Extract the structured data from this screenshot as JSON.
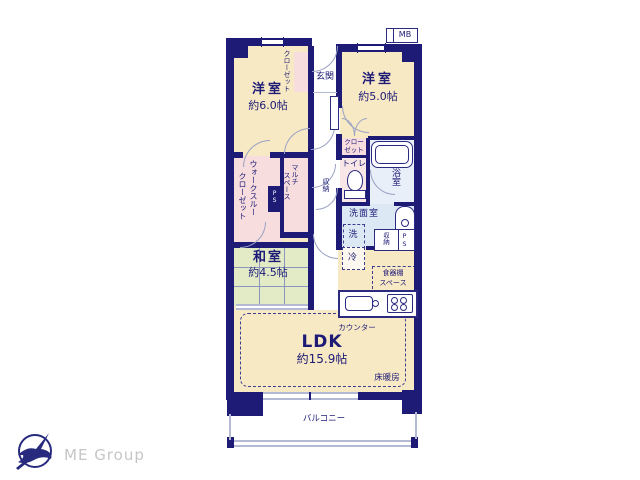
{
  "colors": {
    "wall": "#1d1b76",
    "room_cream": "#f8e9c5",
    "room_pink": "#f7dddd",
    "room_blue": "#dce8f4",
    "room_bath": "#e9eff8",
    "room_green": "#e2ebc6",
    "door_line": "#9aa2c4",
    "text_navy": "#1d1b76",
    "logo_gray": "#c6c6c6"
  },
  "plan": {
    "mb": "MB",
    "entrance": "玄関",
    "western1": {
      "name": "洋室",
      "size": "約6.0帖"
    },
    "western2": {
      "name": "洋室",
      "size": "約5.0帖"
    },
    "japanese": {
      "name": "和室",
      "size": "約4.5帖"
    },
    "ldk": {
      "name": "LDK",
      "size": "約15.9帖"
    },
    "closet_vertical": "クローゼット",
    "closet2_l1": "クロー",
    "closet2_l2": "ゼット",
    "wtc_l1": "ウォークスルー",
    "wtc_l2": "クローゼット",
    "multi_l1": "マルチ",
    "multi_l2": "スペース",
    "toilet": "トイレ",
    "bath": "浴室",
    "washroom": "洗面室",
    "washer": "洗",
    "fridge": "冷",
    "storage_hall": "収納",
    "storage_wash": "収納",
    "ps_small": "PS",
    "ps_wash": "PS",
    "cupboard_l1": "食器棚",
    "cupboard_l2": "スペース",
    "counter": "カウンター",
    "floor_heating": "床暖房",
    "balcony": "バルコニー"
  },
  "logo": {
    "text": "ME Group"
  }
}
